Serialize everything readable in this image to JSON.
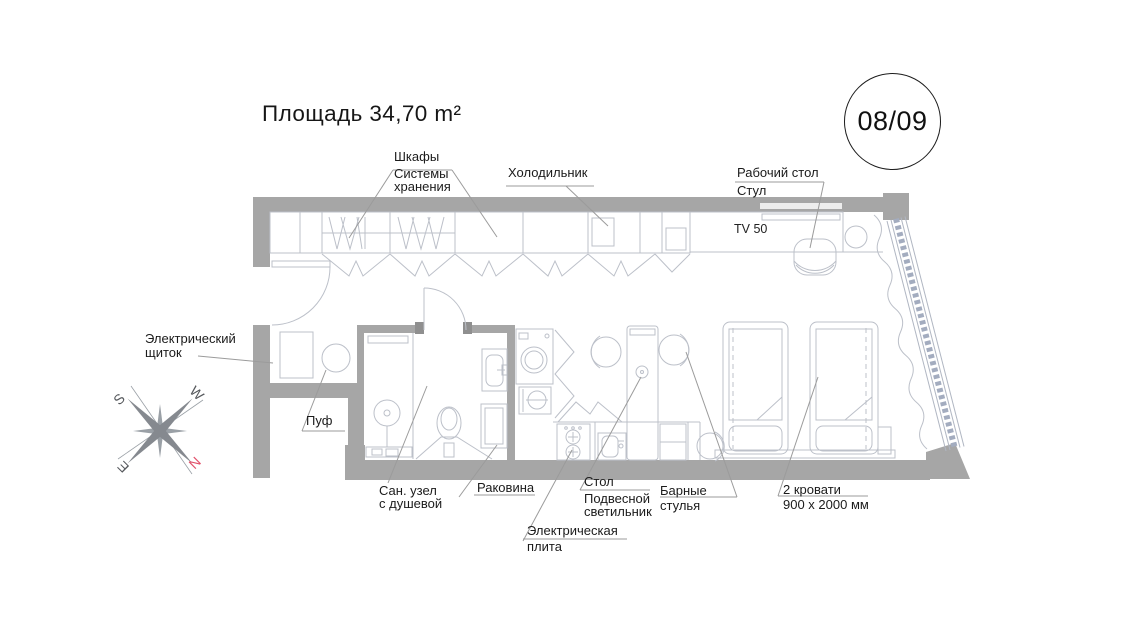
{
  "title": "Площадь 34,70 m²",
  "badge": "08/09",
  "plan": {
    "tv_label": "TV 50",
    "labels": {
      "wardrobe": {
        "lines": [
          "Шкафы",
          "Системы",
          "хранения"
        ]
      },
      "fridge": {
        "lines": [
          "Холодильник"
        ]
      },
      "desk": {
        "lines": [
          "Рабочий стол",
          "Стул"
        ]
      },
      "electrical_panel": {
        "lines": [
          "Электрический",
          "щиток"
        ]
      },
      "pouf": {
        "lines": [
          "Пуф"
        ]
      },
      "bathroom": {
        "lines": [
          "Сан. узел",
          "с душевой"
        ]
      },
      "sink": {
        "lines": [
          "Раковина"
        ]
      },
      "table": {
        "lines": [
          "Стол",
          "Подвесной",
          "светильник"
        ]
      },
      "stove": {
        "lines": [
          "Электрическая",
          "плита"
        ]
      },
      "bar_stools": {
        "lines": [
          "Барные",
          "стулья"
        ]
      },
      "beds": {
        "lines": [
          "2 кровати",
          "900 x 2000 мм"
        ]
      }
    }
  },
  "compass": {
    "n": "N",
    "s": "S",
    "e": "E",
    "w": "W"
  },
  "colors": {
    "wall": "#a6a6a6",
    "furniture_line": "#bcc0c9",
    "glazing": "#a3acbf",
    "leader": "#9b9b9b",
    "text": "#1b1b1b",
    "north": "#e2506a"
  }
}
